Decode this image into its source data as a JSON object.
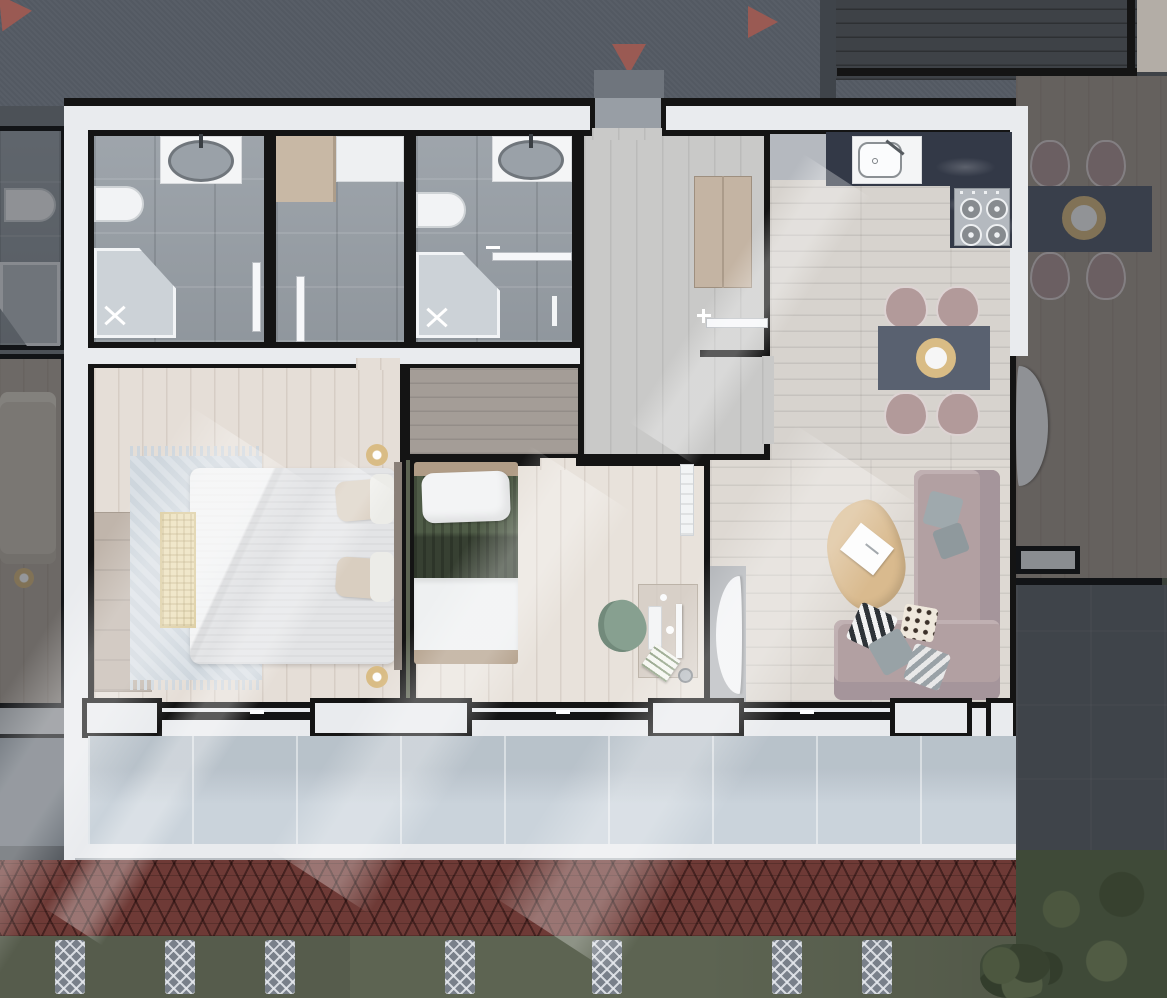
{
  "meta": {
    "description": "3D rendered top-down architectural floor plan of a furnished two-bedroom apartment flanked by two shadowed mirrored neighbor units",
    "view": "top-down render",
    "visible_text": "none"
  },
  "palette": {
    "roof-top": "#535962",
    "roof-deck": "#3e4247",
    "roof-corner": "#b3ada6",
    "arrow-red": "#9a5a53",
    "wall-black": "#141414",
    "wall-fill": "#e9ebee",
    "stone-tile": "#99a0a7",
    "wood-bedroom": "#e5ded7",
    "wood-hall": "#c9c9c8",
    "wood-kitchen": "#d7d3ce",
    "wood-living": "#ded9d3",
    "wood-corridor": "#a49d97",
    "counter-marble": "#333947",
    "counter-gray": "#b5b9bf",
    "sink-white": "#f4f5f6",
    "fixture-gray": "#9aa1a8",
    "stove-gray": "#b4b9bf",
    "table-dark": "#596170",
    "gold": "#d9bc85",
    "chair-mauve": "#b29a9a",
    "sofa-mauve": "#b2a0a2",
    "coffee-wood": "#d9ba8e",
    "duvet": "#e3e4e6",
    "pillow-beige": "#d9cec0",
    "bench-cream": "#eaddb4",
    "rug-blue": "#ced6dd",
    "wardrobe-wood": "#c0b5ab",
    "bed-green": "#4f5c47",
    "sheet-white": "#eef0f1",
    "desk-glass": "#d5cdc4",
    "chair-green": "#87a090",
    "balcony-tile": "#c4ced7",
    "terrace-gray": "#65696f",
    "roof-red": "#6e3a36",
    "ground-green": "#5d6452",
    "bush-green": "#3f4a38",
    "lattice-gray": "#79808a"
  },
  "apartment": {
    "rooms": [
      {
        "id": "bathroom-1",
        "floor": "gray stone tile",
        "fixtures": [
          "vanity with oval sink",
          "wall toilet",
          "corner shower",
          "door"
        ]
      },
      {
        "id": "storage-room",
        "floor": "gray stone tile",
        "fixtures": [
          "wood shelf",
          "white appliance",
          "door"
        ]
      },
      {
        "id": "bathroom-2",
        "floor": "gray stone tile",
        "fixtures": [
          "vanity with oval sink",
          "wall toilet",
          "corner shower",
          "door",
          "towel bar"
        ]
      },
      {
        "id": "hallway",
        "floor": "light gray wood planks",
        "fixtures": [
          "entrance threshold",
          "wood cabinet",
          "door to kitchen"
        ]
      },
      {
        "id": "kitchen-dining",
        "floor": "light wood planks",
        "fixtures": [
          "gray appliance block",
          "dark marble counter",
          "sink with faucet",
          "4-burner stove",
          "dining table",
          "4 mauve chairs",
          "gold centerpiece"
        ]
      },
      {
        "id": "corridor",
        "floor": "dark gray wood planks",
        "fixtures": []
      },
      {
        "id": "master-bedroom",
        "floor": "pale wood planks",
        "fixtures": [
          "double bed",
          "4 beige pillows",
          "2 white pillows",
          "woven bench",
          "fringed rug",
          "wardrobe",
          "2 gold nightstand lamps",
          "headboard"
        ]
      },
      {
        "id": "second-bedroom",
        "floor": "pale wood planks",
        "fixtures": [
          "single bed with green blanket",
          "white pillow",
          "white sheet",
          "desk with monitor and keyboard",
          "notebook",
          "waste bin",
          "green chair",
          "radiator"
        ]
      },
      {
        "id": "living-room",
        "floor": "pale wood planks",
        "fixtures": [
          "L-shaped mauve sofa",
          "6 throw pillows",
          "pebble coffee table",
          "open book",
          "TV console",
          "curved TV"
        ]
      },
      {
        "id": "balcony",
        "floor": "light blue-gray tile",
        "fixtures": [
          "sliding glass doors",
          "white parapet"
        ]
      }
    ]
  },
  "exterior": {
    "roof_arrows": [
      {
        "direction": "up",
        "position": "top-left corner, partially cropped"
      },
      {
        "direction": "down",
        "position": "top center"
      },
      {
        "direction": "right",
        "position": "top center-right"
      }
    ],
    "roof_edge": "red clay shingle strip",
    "ground": "olive lawn strip",
    "fence_post_count": 8,
    "vegetation": "dark bushes bottom-right"
  },
  "neighbors": {
    "left": "mirrored unit in shadow: bathroom with toilet and shower, bedroom with bed and gold lamp, balcony",
    "right": "mirrored unit in shadow: dining table with 4 chairs and gold centerpiece, curved TV, dark tiled terrace"
  }
}
